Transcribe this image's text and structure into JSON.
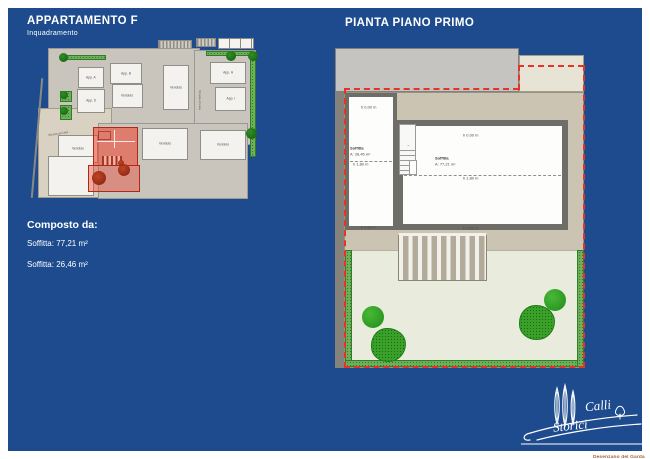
{
  "colors": {
    "background_blue": "#1d4b8e",
    "boundary_red": "#e63325",
    "highlight_red": "#ee4634",
    "hedge_green": "#6faf5c",
    "tree_green": "#2f9e25",
    "text_white": "#ffffff",
    "tagline_brown": "#a85d2e"
  },
  "header": {
    "left_title": "APPARTAMENTO F",
    "left_subtitle": "Inquadramento",
    "right_title": "PIANTA PIANO PRIMO"
  },
  "summary": {
    "heading": "Composto da:",
    "items": [
      "Soffitta: 77,21 m²",
      "Soffitta: 26,46 m²"
    ]
  },
  "siteplan": {
    "apartments": {
      "a": "App. A",
      "b": "App. B",
      "d": "App. D",
      "h": "App. H",
      "i": "App. I"
    },
    "sold_label": "Venduto",
    "street_label": "Strada privata"
  },
  "floorplan": {
    "small_room": {
      "name": "Soffitta",
      "area": "A: 26,46 m²"
    },
    "large_room": {
      "name": "Soffitta",
      "area": "A: 77,21 m²"
    },
    "height_zero": "h 0,00 m",
    "height_mid": "h 1,80 m"
  },
  "logo": {
    "word1": "Calli",
    "word2": "Storici",
    "tagline": "Desenzano del Garda"
  }
}
